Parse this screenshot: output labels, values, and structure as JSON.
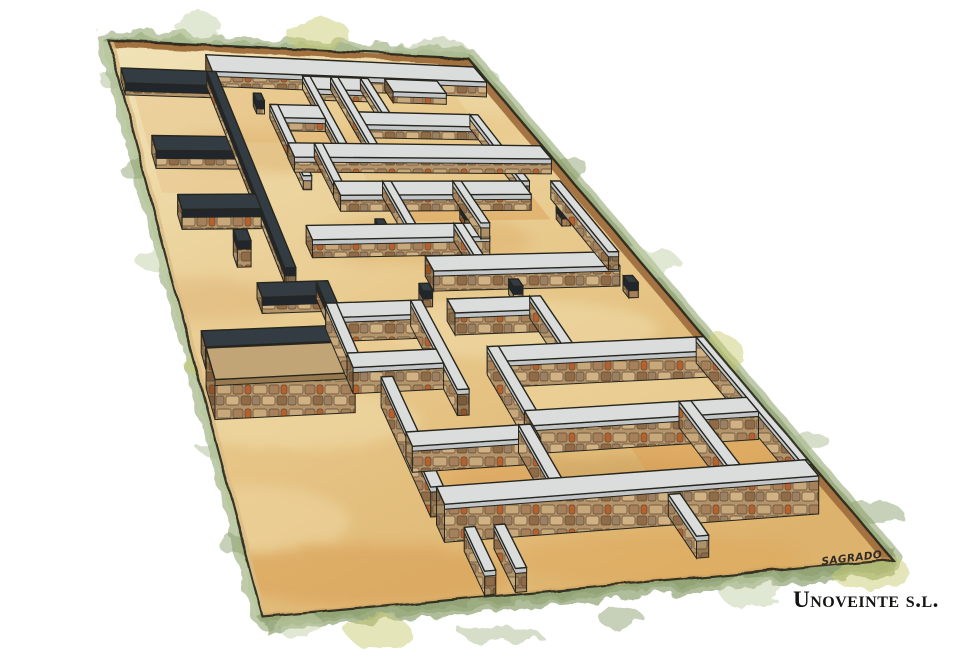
{
  "credits": {
    "signature": "SAGRADO",
    "company": "Unoveinte s.l."
  },
  "palette": {
    "paper": "#ffffff",
    "ink": "#26261e",
    "ground_light": "#f1e3b8",
    "ground_mid": "#e8c98c",
    "ground_deep": "#ddb26c",
    "wash_orange": "#d8a45c",
    "gray_cap_top": "#dbdddd",
    "gray_cap_side": "#c3c6c8",
    "dark_cap_top": "#333c42",
    "dark_cap_side": "#20262b",
    "stone_cap_top": "#c2a577",
    "stone_cap_side": "#97794f",
    "stone_base": "#b3946a",
    "brick_red": "#b5602f",
    "earth_bank": "#9c6a38",
    "earth_bank_dark": "#6f4828",
    "green_base": "#aebd95",
    "green_mid": "#8fa170",
    "green_light": "#c2cfa8",
    "green_yellow": "#c9cb74"
  },
  "site": {
    "scene": "excavated-ruins-axonometric",
    "corners": {
      "tl": [
        108,
        40
      ],
      "tr": [
        468,
        58
      ],
      "br": [
        893,
        560
      ],
      "bl": [
        263,
        617
      ]
    },
    "floors": [
      {
        "id": "floor-grid-a-west",
        "u1": 0.27,
        "v1": 0.06,
        "u2": 0.5,
        "v2": 0.175,
        "fill": "#e3b873",
        "op": 0.5
      },
      {
        "id": "floor-grid-a-east",
        "u1": 0.52,
        "v1": 0.06,
        "u2": 0.88,
        "v2": 0.245,
        "fill": "#e7c17d",
        "op": 0.45
      },
      {
        "id": "floor-grid-a-south",
        "u1": 0.56,
        "v1": 0.25,
        "u2": 0.88,
        "v2": 0.32,
        "fill": "#de9f55",
        "op": 0.5
      },
      {
        "id": "floor-dark-rooms",
        "u1": 0.03,
        "v1": 0.06,
        "u2": 0.245,
        "v2": 0.265,
        "fill": "#e6c287",
        "op": 0.45
      },
      {
        "id": "floor-house-b-right",
        "u1": 0.59,
        "v1": 0.57,
        "u2": 0.985,
        "v2": 0.675,
        "fill": "#eed9a4",
        "op": 0.55
      },
      {
        "id": "floor-house-b-left",
        "u1": 0.3,
        "v1": 0.468,
        "u2": 0.6,
        "v2": 0.553,
        "fill": "#edd09a",
        "op": 0.5
      },
      {
        "id": "floor-house-c-left",
        "u1": 0.35,
        "v1": 0.705,
        "u2": 0.575,
        "v2": 0.8,
        "fill": "#e3aa5f",
        "op": 0.5
      },
      {
        "id": "floor-house-c-right",
        "u1": 0.72,
        "v1": 0.68,
        "u2": 0.985,
        "v2": 0.8,
        "fill": "#dc9e52",
        "op": 0.5
      }
    ],
    "structures": [
      {
        "id": "north-perimeter-wall",
        "kind": "cross",
        "v": 0.018,
        "from": 0.26,
        "to": 0.995,
        "t": 0.03,
        "h": 15,
        "cap": "gray"
      },
      {
        "id": "dark-wall-north",
        "kind": "cross",
        "v": 0.048,
        "from": 0.015,
        "to": 0.265,
        "t": 0.026,
        "h": 12,
        "cap": "dark"
      },
      {
        "id": "grid-a-north-wall-w",
        "kind": "cross",
        "v": 0.05,
        "from": 0.5,
        "to": 0.665,
        "t": 0.024,
        "h": 11,
        "cap": "gray"
      },
      {
        "id": "grid-a-north-wall-e",
        "kind": "cross",
        "v": 0.05,
        "from": 0.72,
        "to": 0.86,
        "t": 0.024,
        "h": 11,
        "cap": "gray"
      },
      {
        "id": "grid-a-long-ne",
        "kind": "long",
        "u": 0.655,
        "from": 0.05,
        "to": 0.115,
        "t": 0.02,
        "h": 12,
        "cap": "gray"
      },
      {
        "id": "grid-a-long-w",
        "kind": "long",
        "u": 0.5,
        "from": 0.05,
        "to": 0.175,
        "t": 0.02,
        "h": 13,
        "cap": "gray"
      },
      {
        "id": "pillar-1",
        "kind": "pillar",
        "u": 0.345,
        "v": 0.085,
        "s": 0.02,
        "h": 13,
        "cap": "dark"
      },
      {
        "id": "grid-a-cross-1",
        "kind": "cross",
        "v": 0.105,
        "from": 0.375,
        "to": 0.5,
        "t": 0.024,
        "h": 13,
        "cap": "gray"
      },
      {
        "id": "grid-a-long-sw",
        "kind": "long",
        "u": 0.375,
        "from": 0.105,
        "to": 0.235,
        "t": 0.02,
        "h": 14,
        "cap": "gray"
      },
      {
        "id": "grid-a-cross-2",
        "kind": "cross",
        "v": 0.115,
        "from": 0.575,
        "to": 0.88,
        "t": 0.024,
        "h": 13,
        "cap": "gray"
      },
      {
        "id": "grid-a-long-mid",
        "kind": "long",
        "u": 0.575,
        "from": 0.05,
        "to": 0.175,
        "t": 0.02,
        "h": 13,
        "cap": "gray"
      },
      {
        "id": "grid-a-long-e",
        "kind": "long",
        "u": 0.88,
        "from": 0.115,
        "to": 0.245,
        "t": 0.02,
        "h": 14,
        "cap": "gray"
      },
      {
        "id": "grid-a-cross-3",
        "kind": "cross",
        "v": 0.175,
        "from": 0.375,
        "to": 0.995,
        "t": 0.026,
        "h": 15,
        "cap": "gray"
      },
      {
        "id": "dark-wall-mid",
        "kind": "cross",
        "v": 0.165,
        "from": 0.045,
        "to": 0.245,
        "t": 0.026,
        "h": 18,
        "cap": "dark"
      },
      {
        "id": "dark-wall-spine",
        "kind": "long",
        "u": 0.245,
        "from": 0.048,
        "to": 0.4,
        "t": 0.024,
        "h": 16,
        "cap": "dark"
      },
      {
        "id": "grid-a-long-s1",
        "kind": "long",
        "u": 0.44,
        "from": 0.175,
        "to": 0.245,
        "t": 0.02,
        "h": 15,
        "cap": "gray"
      },
      {
        "id": "grid-a-cross-4",
        "kind": "cross",
        "v": 0.245,
        "from": 0.44,
        "to": 0.88,
        "t": 0.026,
        "h": 16,
        "cap": "gray"
      },
      {
        "id": "dark-wall-south",
        "kind": "cross",
        "v": 0.268,
        "from": 0.065,
        "to": 0.245,
        "t": 0.026,
        "h": 20,
        "cap": "dark"
      },
      {
        "id": "pillar-5",
        "kind": "pillar",
        "u": 0.165,
        "v": 0.33,
        "s": 0.03,
        "h": 26,
        "cap": "dark"
      },
      {
        "id": "grid-a-long-s2",
        "kind": "long",
        "u": 0.555,
        "from": 0.245,
        "to": 0.325,
        "t": 0.02,
        "h": 16,
        "cap": "gray"
      },
      {
        "id": "pillar-3",
        "kind": "pillar",
        "u": 0.7,
        "v": 0.29,
        "s": 0.02,
        "h": 15,
        "cap": "dark"
      },
      {
        "id": "pillar-4",
        "kind": "pillar",
        "u": 0.92,
        "v": 0.29,
        "s": 0.02,
        "h": 15,
        "cap": "dark"
      },
      {
        "id": "pillar-2",
        "kind": "pillar",
        "u": 0.49,
        "v": 0.315,
        "s": 0.02,
        "h": 16,
        "cap": "dark"
      },
      {
        "id": "grid-a-cross-5",
        "kind": "cross",
        "v": 0.325,
        "from": 0.33,
        "to": 0.72,
        "t": 0.026,
        "h": 18,
        "cap": "gray"
      },
      {
        "id": "grid-a-long-s3",
        "kind": "long",
        "u": 0.72,
        "from": 0.245,
        "to": 0.325,
        "t": 0.02,
        "h": 16,
        "cap": "gray"
      },
      {
        "id": "grid-a-long-s4",
        "kind": "long",
        "u": 0.66,
        "from": 0.325,
        "to": 0.385,
        "t": 0.02,
        "h": 18,
        "cap": "gray"
      },
      {
        "id": "grid-a-cross-6",
        "kind": "cross",
        "v": 0.385,
        "from": 0.555,
        "to": 0.95,
        "t": 0.028,
        "h": 20,
        "cap": "gray"
      },
      {
        "id": "grid-a-long-edge",
        "kind": "long",
        "u": 0.95,
        "from": 0.245,
        "to": 0.385,
        "t": 0.022,
        "h": 18,
        "cap": "gray"
      },
      {
        "id": "dark-corner-north",
        "kind": "cross",
        "v": 0.425,
        "from": 0.175,
        "to": 0.3,
        "t": 0.026,
        "h": 16,
        "cap": "dark"
      },
      {
        "id": "dark-corner-long",
        "kind": "long",
        "u": 0.3,
        "from": 0.425,
        "to": 0.505,
        "t": 0.024,
        "h": 18,
        "cap": "dark"
      },
      {
        "id": "dark-corner-south",
        "kind": "cross",
        "v": 0.505,
        "from": 0.03,
        "to": 0.3,
        "t": 0.028,
        "h": 22,
        "cap": "dark"
      },
      {
        "id": "rubble-bastion",
        "kind": "cross",
        "v": 0.535,
        "from": 0.03,
        "to": 0.3,
        "t": 0.055,
        "h": 40,
        "cap": "stone"
      },
      {
        "id": "pillar-6",
        "kind": "pillar",
        "u": 0.51,
        "v": 0.435,
        "s": 0.02,
        "h": 16,
        "cap": "dark"
      },
      {
        "id": "pillar-7",
        "kind": "pillar",
        "u": 0.7,
        "v": 0.432,
        "s": 0.02,
        "h": 15,
        "cap": "dark"
      },
      {
        "id": "pillar-8",
        "kind": "pillar",
        "u": 0.94,
        "v": 0.432,
        "s": 0.02,
        "h": 15,
        "cap": "dark"
      },
      {
        "id": "house-b-north-w",
        "kind": "cross",
        "v": 0.465,
        "from": 0.3,
        "to": 0.475,
        "t": 0.026,
        "h": 24,
        "cap": "gray"
      },
      {
        "id": "house-b-west",
        "kind": "long",
        "u": 0.3,
        "from": 0.465,
        "to": 0.555,
        "t": 0.022,
        "h": 26,
        "cap": "gray"
      },
      {
        "id": "house-b-spine",
        "kind": "long",
        "u": 0.475,
        "from": 0.465,
        "to": 0.63,
        "t": 0.022,
        "h": 26,
        "cap": "gray"
      },
      {
        "id": "house-b-north-e",
        "kind": "cross",
        "v": 0.465,
        "from": 0.55,
        "to": 0.72,
        "t": 0.026,
        "h": 22,
        "cap": "gray"
      },
      {
        "id": "house-b-long-e",
        "kind": "long",
        "u": 0.72,
        "from": 0.465,
        "to": 0.555,
        "t": 0.022,
        "h": 22,
        "cap": "gray"
      },
      {
        "id": "house-b-cross-s",
        "kind": "cross",
        "v": 0.555,
        "from": 0.3,
        "to": 0.475,
        "t": 0.026,
        "h": 26,
        "cap": "gray"
      },
      {
        "id": "house-b-cross-mid",
        "kind": "cross",
        "v": 0.555,
        "from": 0.575,
        "to": 0.985,
        "t": 0.028,
        "h": 26,
        "cap": "gray"
      },
      {
        "id": "house-b-long-mid",
        "kind": "long",
        "u": 0.575,
        "from": 0.555,
        "to": 0.675,
        "t": 0.022,
        "h": 28,
        "cap": "gray"
      },
      {
        "id": "house-b-east",
        "kind": "long",
        "u": 0.985,
        "from": 0.555,
        "to": 0.8,
        "t": 0.024,
        "h": 26,
        "cap": "gray"
      },
      {
        "id": "house-b-cross-low",
        "kind": "cross",
        "v": 0.675,
        "from": 0.575,
        "to": 0.985,
        "t": 0.028,
        "h": 28,
        "cap": "gray"
      },
      {
        "id": "house-c-west",
        "kind": "long",
        "u": 0.345,
        "from": 0.6,
        "to": 0.8,
        "t": 0.022,
        "h": 30,
        "cap": "gray"
      },
      {
        "id": "house-c-cross-mid",
        "kind": "cross",
        "v": 0.7,
        "from": 0.345,
        "to": 0.575,
        "t": 0.026,
        "h": 26,
        "cap": "gray"
      },
      {
        "id": "house-c-long-mid",
        "kind": "long",
        "u": 0.55,
        "from": 0.7,
        "to": 0.8,
        "t": 0.022,
        "h": 28,
        "cap": "gray"
      },
      {
        "id": "house-c-long-e",
        "kind": "long",
        "u": 0.86,
        "from": 0.675,
        "to": 0.8,
        "t": 0.022,
        "h": 26,
        "cap": "gray"
      },
      {
        "id": "house-c-south",
        "kind": "cross",
        "v": 0.8,
        "from": 0.355,
        "to": 0.995,
        "t": 0.032,
        "h": 38,
        "cap": "gray"
      },
      {
        "id": "stub-sw-1",
        "kind": "long",
        "u": 0.37,
        "from": 0.875,
        "to": 0.955,
        "t": 0.018,
        "h": 24,
        "cap": "gray"
      },
      {
        "id": "stub-sw-2",
        "kind": "long",
        "u": 0.42,
        "from": 0.875,
        "to": 0.955,
        "t": 0.018,
        "h": 24,
        "cap": "gray"
      },
      {
        "id": "stub-s-e",
        "kind": "long",
        "u": 0.73,
        "from": 0.845,
        "to": 0.925,
        "t": 0.02,
        "h": 22,
        "cap": "gray"
      }
    ]
  }
}
